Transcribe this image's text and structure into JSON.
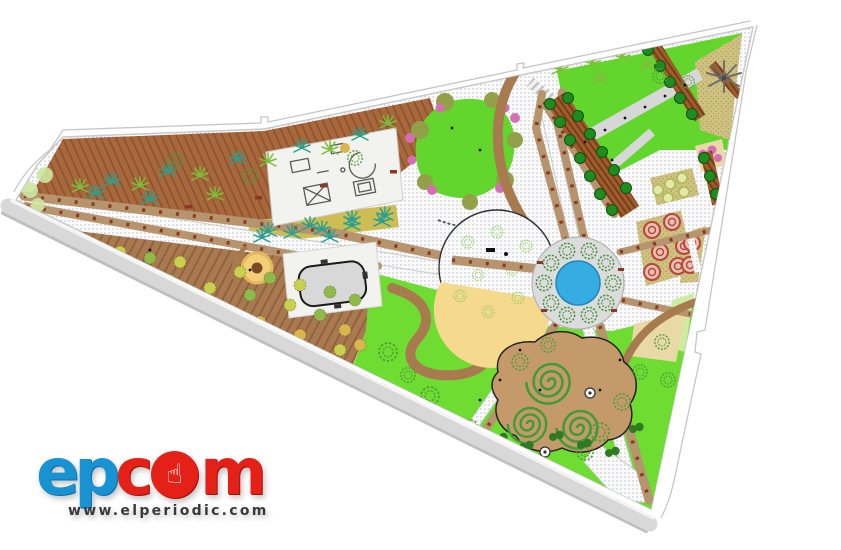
{
  "logo": {
    "part1": "ep",
    "part2": "c",
    "part3": "m",
    "url": "www.elperiodic.com"
  },
  "icons": {
    "hand_cursor": "☝"
  },
  "palette": {
    "road": "#d8d8d8",
    "roadEdge": "#bfbfbf",
    "curb": "#f4f4f4",
    "parcel": "#c6c6c6",
    "hatchDot": "#b4bac2",
    "walkGrey": "#d7d7d7",
    "brownStrip": "#a8683c",
    "brownStripLine": "#8d5230",
    "deck": "#a97a50",
    "deckLine": "#926240",
    "pathTan": "#b5946e",
    "bench": "#8a3a22",
    "arcBrown": "#a87b4f",
    "lawnBright": "#6fdc32",
    "lawnMid": "#62d62c",
    "lawnPale": "#cdeca0",
    "sand": "#f5d98d",
    "sandBed": "#e9d9a6",
    "stripYellow": "#cdbd52",
    "pond": "#35ace2",
    "pondEdge": "#2187b8",
    "plaza": "#dcdcdc",
    "plazaEdge": "#b2b2b2",
    "treeScrib": "#4f9c3a",
    "treeLight": "#8fce5a",
    "treeDark": "#1f8c1f",
    "palmTeal": "#2aa08d",
    "fernGreen": "#7cbf3a",
    "bushYellow": "#c9cf4e",
    "bushGreen": "#8fba4a",
    "bushMustard": "#d8b64d",
    "pergola": "#a05c2c",
    "pergolaLine": "#713d18",
    "khaki": "#cfc180",
    "khakiDot": "#ab9a58",
    "rose": "#b8473a",
    "roseFill": "#e8c0b2",
    "pinkFlower": "#d46fb4",
    "olive": "#93a048",
    "spiralGround": "#c59a6b",
    "spiralLine": "#3f9c35",
    "padWhite": "#f2f2ee",
    "equip": "#5a5a5a",
    "poolFill": "#d8d8d8",
    "poolEdge": "#1a1a1a",
    "tanCircle": "#f2cf77",
    "tanCircleDot": "#7b4a22",
    "logoBlue": "#1792d2",
    "logoBlueDark": "#0d6fa6",
    "logoRed": "#e42017",
    "logoRedDark": "#9e120e",
    "urlGrey": "#3a3a3a"
  }
}
